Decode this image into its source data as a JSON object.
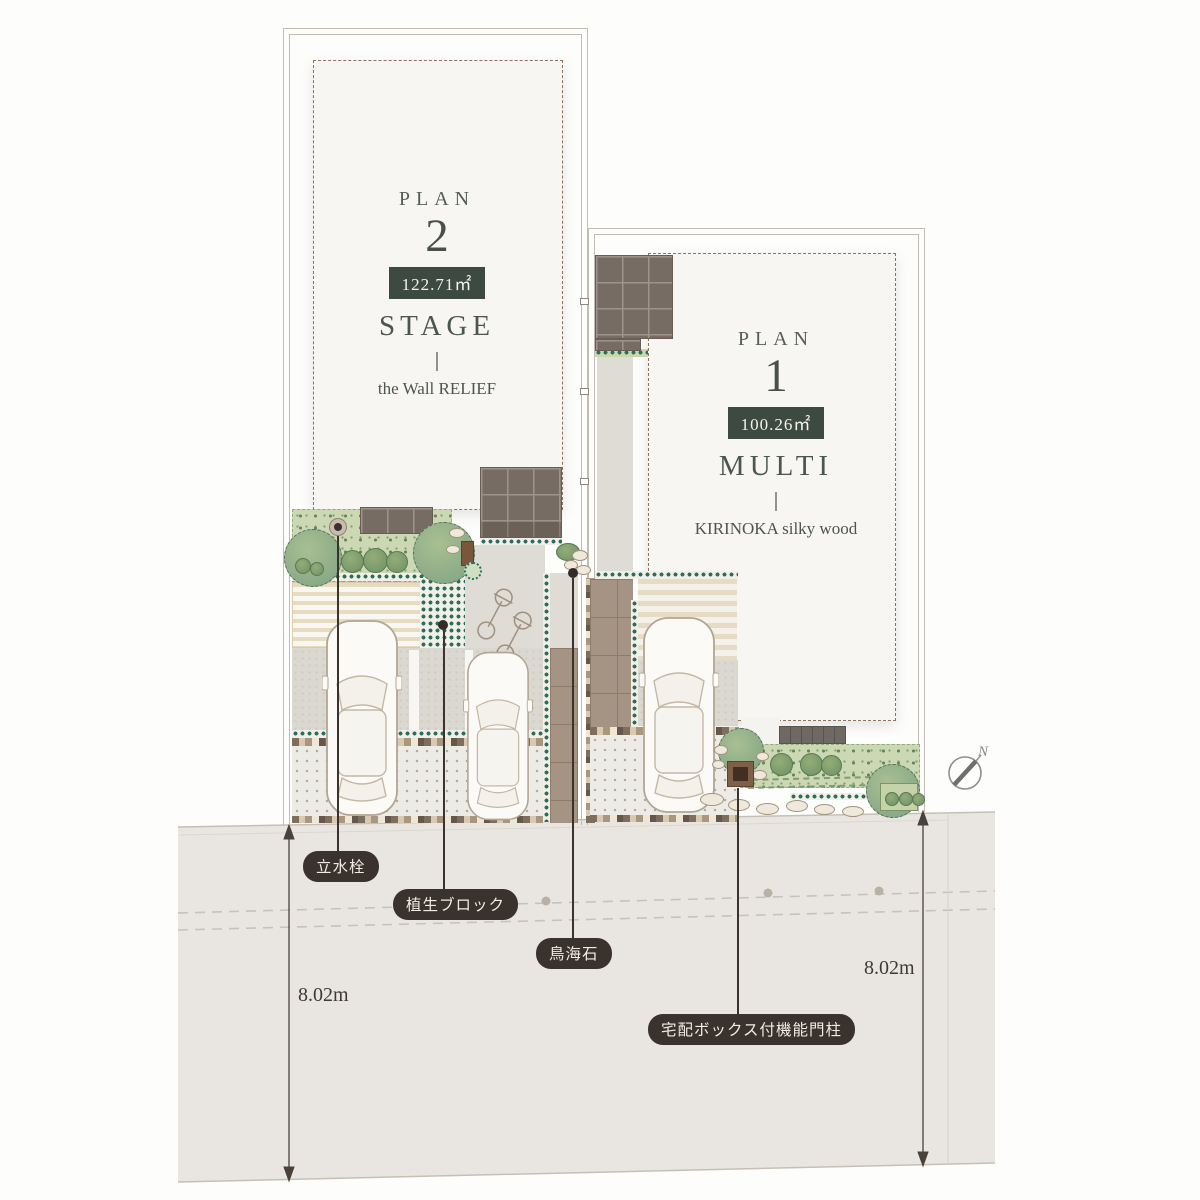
{
  "plan2": {
    "label": "PLAN",
    "number": "2",
    "area": "122.71㎡",
    "name": "STAGE",
    "subtitle": "the Wall RELIEF"
  },
  "plan1": {
    "label": "PLAN",
    "number": "1",
    "area": "100.26㎡",
    "name": "MULTI",
    "subtitle": "KIRINOKA silky wood"
  },
  "callouts": {
    "standpipe": {
      "text": "立水栓"
    },
    "vegetation_block": {
      "text": "植生ブロック"
    },
    "chokai_stone": {
      "text": "鳥海石"
    },
    "gate_post": {
      "text": "宅配ボックス付機能門柱"
    }
  },
  "dimensions": {
    "left": {
      "value": "8.02m"
    },
    "right": {
      "value": "8.02m"
    }
  },
  "compass": {
    "label": "N"
  },
  "colors": {
    "badge_green": "#3d4a42",
    "pill_dark": "#39322d",
    "plan_text": "#4c564e",
    "road_gray": "#e9e6e2",
    "roof_brown": "#776c64",
    "planting_green": "#ccd8b4",
    "tile_teal": "#2c6e59",
    "paver_brown": "#a59484"
  }
}
